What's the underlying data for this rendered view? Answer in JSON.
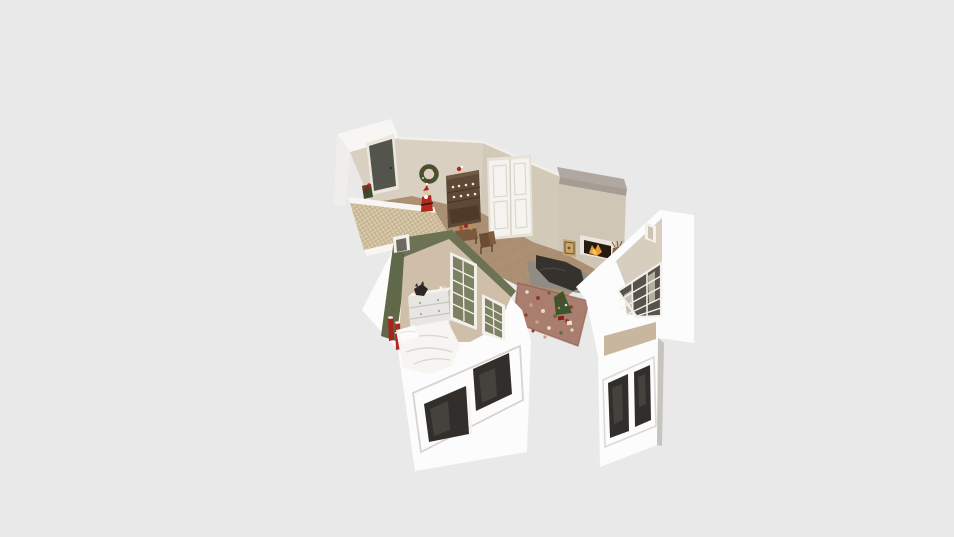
{
  "scene": {
    "type": "isometric-3d-floorplan-render",
    "canvas": {
      "width": 954,
      "height": 537
    },
    "background_color": "#e9e9e9",
    "palette": {
      "white_wall": "#fcfcfc",
      "white_band": "#f7f6f3",
      "beige_light": "#d9d0c2",
      "beige": "#d3c9b9",
      "beige_dark": "#d0c6b6",
      "den_beige": "#d8cec0",
      "green_wall": "#6d7254",
      "green_wall_dark": "#5f6848",
      "tile_floor": "#ab9074",
      "carpet": "#cfbfa8",
      "den_floor": "#c9b69e",
      "wicker": "#d8cbae",
      "door_dark": "#53544b",
      "closet_white": "#f4f3ef",
      "chimney_gray": "#b0a8a0",
      "hutch_brown": "#5e4936",
      "santa_red": "#b3271d",
      "wreath_green": "#46532f",
      "sofa_dark": "#35322e",
      "rug_gray": "#908c85",
      "rug_floral": "#a97e6e",
      "tree_green": "#3d5430",
      "accent_red": "#a7241c",
      "dresser_white": "#e8e6e2",
      "bed_white": "#f6f5f2",
      "glass_dark": "#312e2b",
      "glass_green": "#7e8063",
      "frame_white": "#f1efe9",
      "fire_orange": "#e89b3a"
    },
    "rooms": [
      "entry-hall",
      "dining-area",
      "living-room",
      "den",
      "bedroom"
    ],
    "objects": [
      "front-door",
      "poinsettia-plant",
      "christmas-wreath",
      "santa-figure",
      "china-hutch",
      "closet-double-doors",
      "side-table-with-flowers",
      "dining-chair",
      "chimney",
      "fireplace",
      "framed-picture",
      "reindeer-figurine",
      "sofa",
      "gray-rug",
      "floral-rug",
      "christmas-tree",
      "den-door",
      "den-grid-window",
      "den-exterior-window",
      "bedroom-door",
      "dresser",
      "cat-on-dresser",
      "red-candles",
      "bed",
      "french-doors",
      "bedroom-exterior-window",
      "wicker-wall"
    ]
  }
}
